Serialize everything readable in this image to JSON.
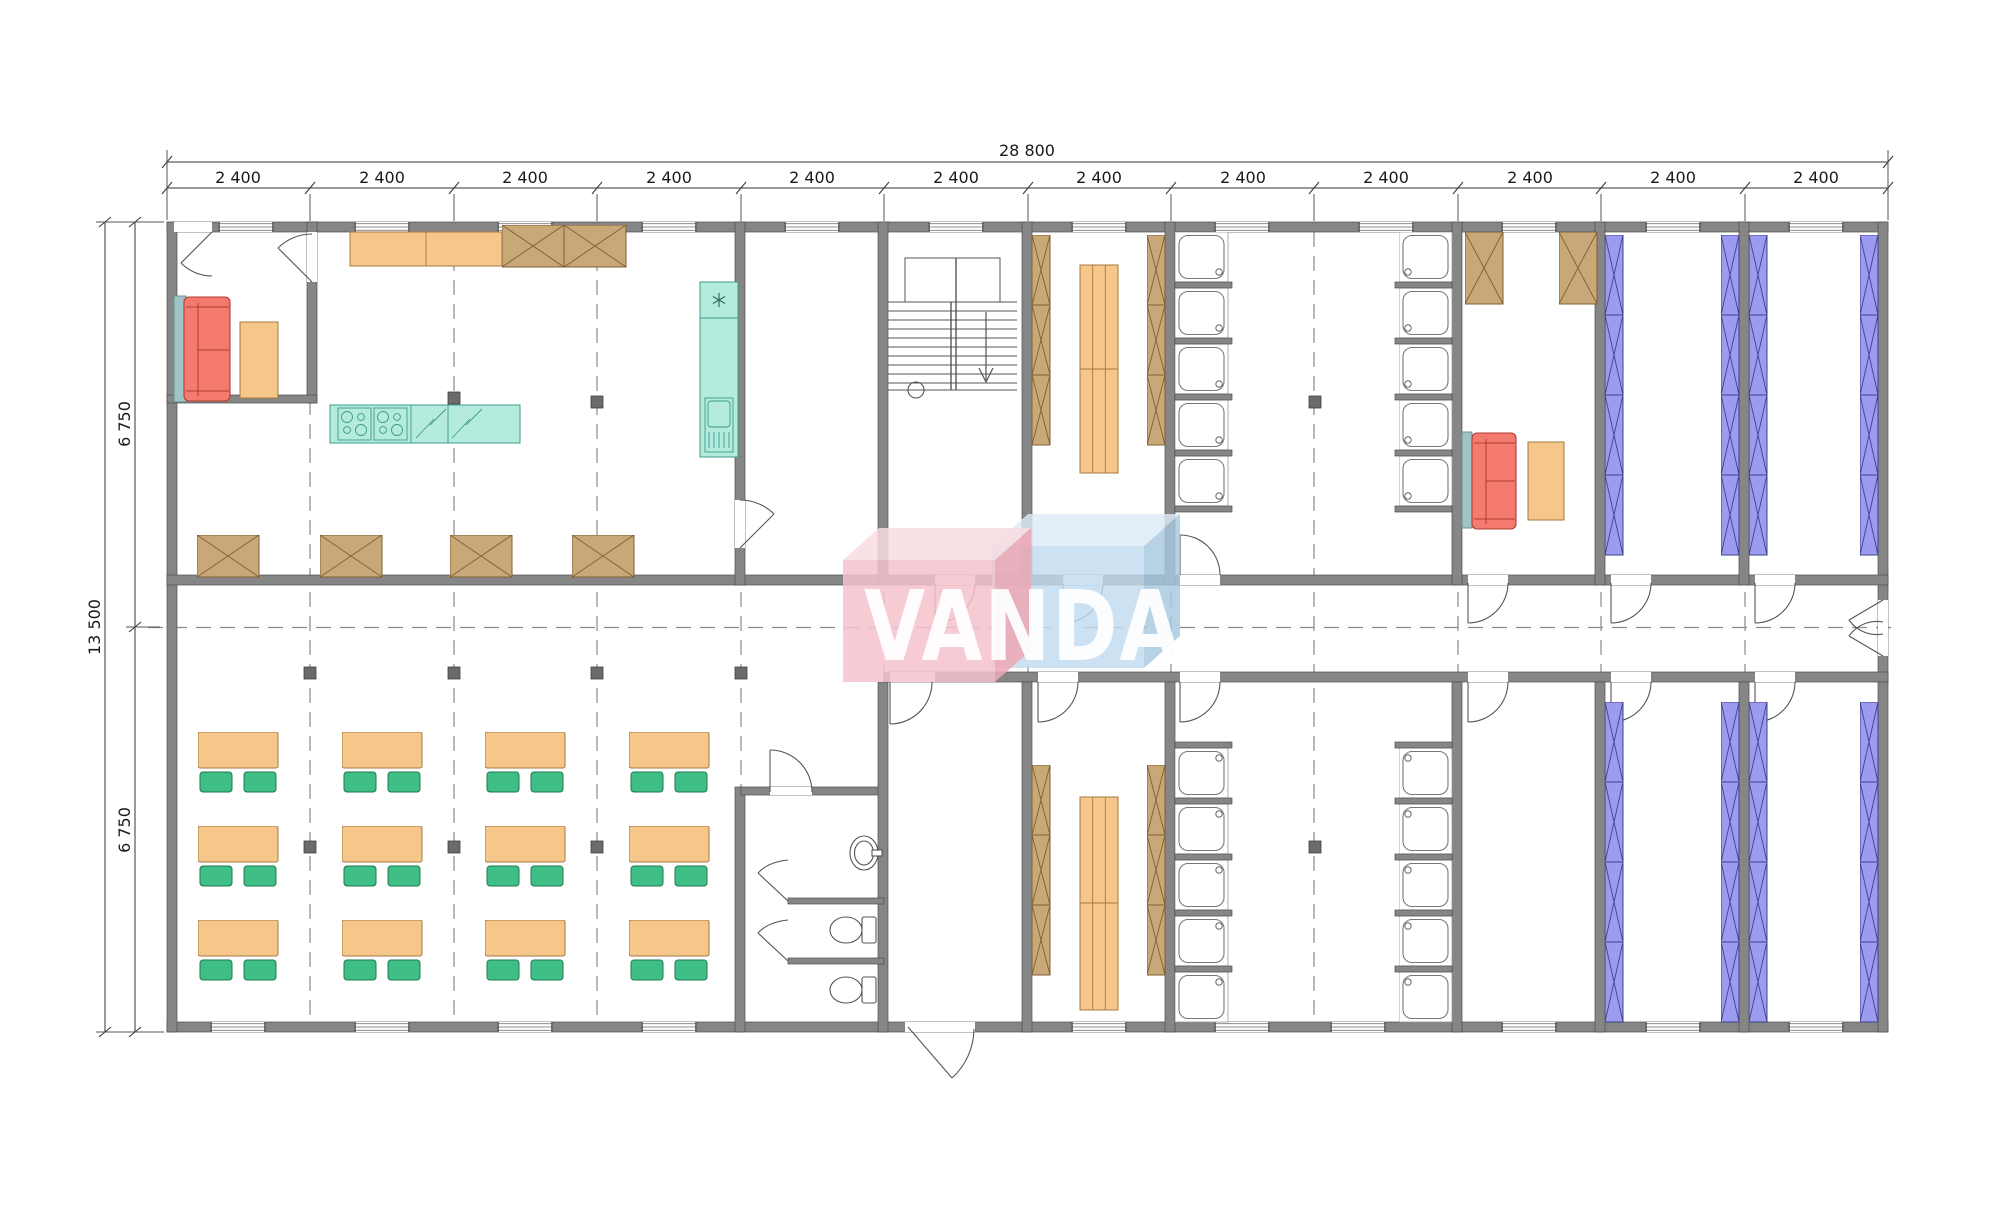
{
  "page": {
    "title": "VANDA modular building floor plan"
  },
  "dimensions": {
    "total_width_label": "28 800",
    "module_labels": [
      "2 400",
      "2 400",
      "2 400",
      "2 400",
      "2 400",
      "2 400",
      "2 400",
      "2 400",
      "2 400",
      "2 400",
      "2 400",
      "2 400"
    ],
    "total_depth_label": "13 500",
    "half_depth_labels": [
      "6 750",
      "6 750"
    ]
  },
  "logo": {
    "text": "VANDA",
    "block_pink": "#f6c3cd",
    "block_blue": "#c2dbee",
    "letter_color": "#ffffff"
  },
  "colors": {
    "wall_gray": "#868686",
    "furniture_orange": "#f7c68b",
    "locker_tan": "#c9a878",
    "chair_green": "#3fbe85",
    "sofa_red": "#f4796e",
    "kitchen_teal": "#b4ebdc",
    "bed_blue": "#9b9bef",
    "axis_gray": "#8a8a8a"
  }
}
